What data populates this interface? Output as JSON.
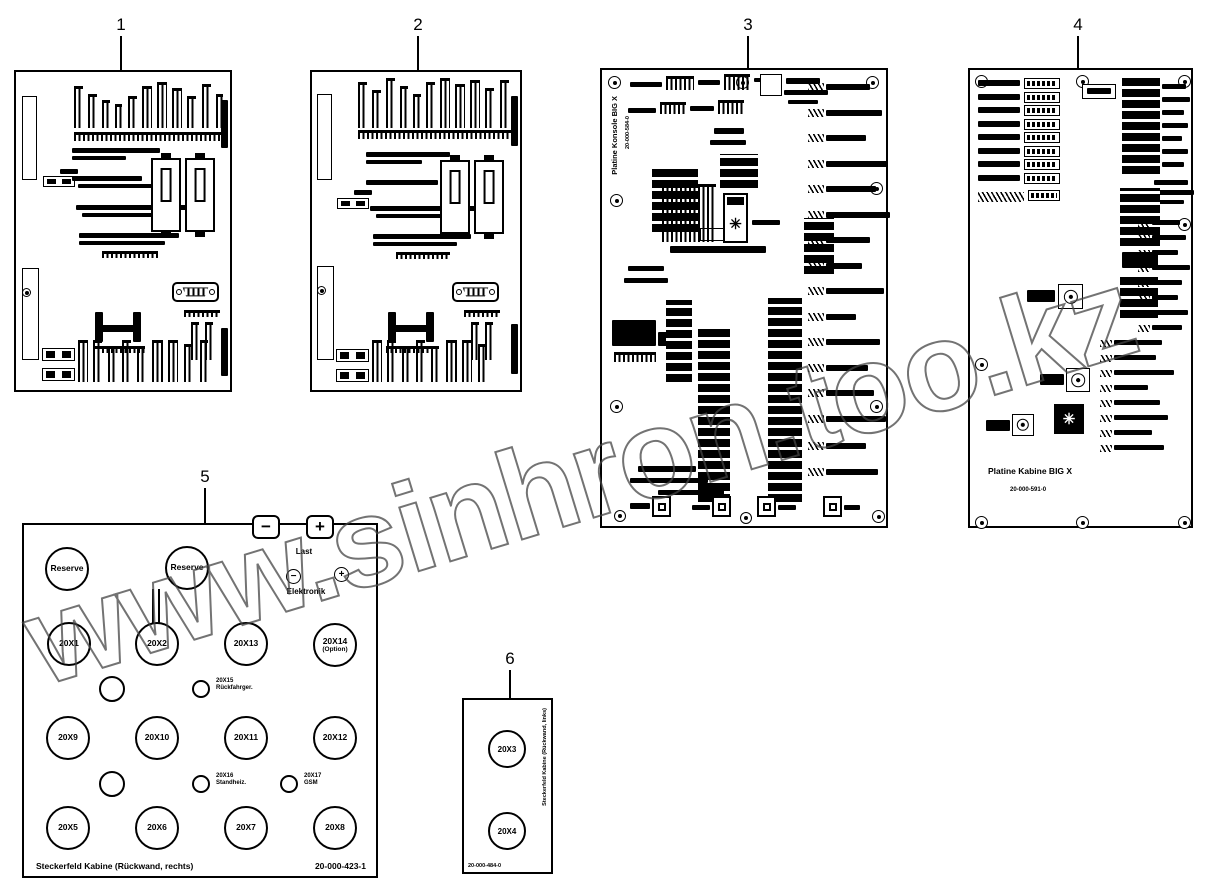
{
  "watermark": {
    "text": "www.sinhron.too.kz"
  },
  "callouts": {
    "c1": "1",
    "c2": "2",
    "c3": "3",
    "c4": "4",
    "c5": "5",
    "c6": "6"
  },
  "icons": {
    "snowflake": "✳"
  },
  "board3": {
    "title": "Platine Konsole BIG X",
    "part_number": "20-000-584-0"
  },
  "board4": {
    "title": "Platine Kabine BIG X",
    "part_number": "20-000-591-0"
  },
  "panel5": {
    "title": "Steckerfeld Kabine (Rückwand, rechts)",
    "part_number": "20-000-423-1",
    "reserve1": "Reserve",
    "reserve2": "Reserve",
    "battery": {
      "minus": "−",
      "plus": "+",
      "last": "Last",
      "elektronik": "Elektronik"
    },
    "row2": [
      "20X1",
      "20X2",
      "20X13",
      "20X14"
    ],
    "row2_note": "(Option)",
    "row3": [
      "20X9",
      "20X10",
      "20X11",
      "20X12"
    ],
    "row4": [
      "20X5",
      "20X6",
      "20X7",
      "20X8"
    ],
    "small1": {
      "line1": "20X15",
      "line2": "Rückfahrger."
    },
    "small2": {
      "line1": "20X16",
      "line2": "Standheiz."
    },
    "small3": {
      "line1": "20X17",
      "line2": "GSM"
    }
  },
  "panel6": {
    "side_text": "Steckerfeld Kabine (Rückwand, links)",
    "part_number": "20-000-484-0",
    "x3": "20X3",
    "x4": "20X4"
  }
}
